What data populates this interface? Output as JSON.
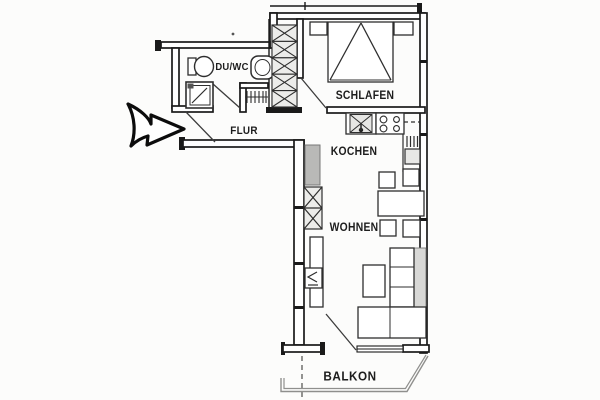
{
  "plan": {
    "type": "apartment-floor-plan",
    "rooms": {
      "duwc": {
        "label": "DU/WC"
      },
      "schlafen": {
        "label": "SCHLAFEN"
      },
      "flur": {
        "label": "FLUR"
      },
      "kochen": {
        "label": "KOCHEN"
      },
      "wohnen": {
        "label": "WOHNEN"
      },
      "balkon": {
        "label": "BALKON"
      }
    },
    "fixtures": [
      "entrance-arrow-icon",
      "toilet-icon",
      "washbasin-icon",
      "shower-icon",
      "radiator-icon",
      "wardrobe-icon",
      "bed-icon",
      "nightstand",
      "kitchen-sink-icon",
      "stove-icon",
      "kitchen-block",
      "shelf-cabinet",
      "dining-table",
      "chair",
      "sideboard",
      "tv-icon",
      "coffee-table",
      "sofa",
      "balcony-railing",
      "balcony-divider"
    ],
    "colors": {
      "wall": "#1a1a1a",
      "furniture_line": "#2e2e2e",
      "cabinet_fill": "#ececea",
      "block_fill": "#b9b9b7",
      "sofa_back_fill": "#d8d8d6",
      "railing": "#8f8f8d",
      "background": "#fcfcfb"
    }
  }
}
